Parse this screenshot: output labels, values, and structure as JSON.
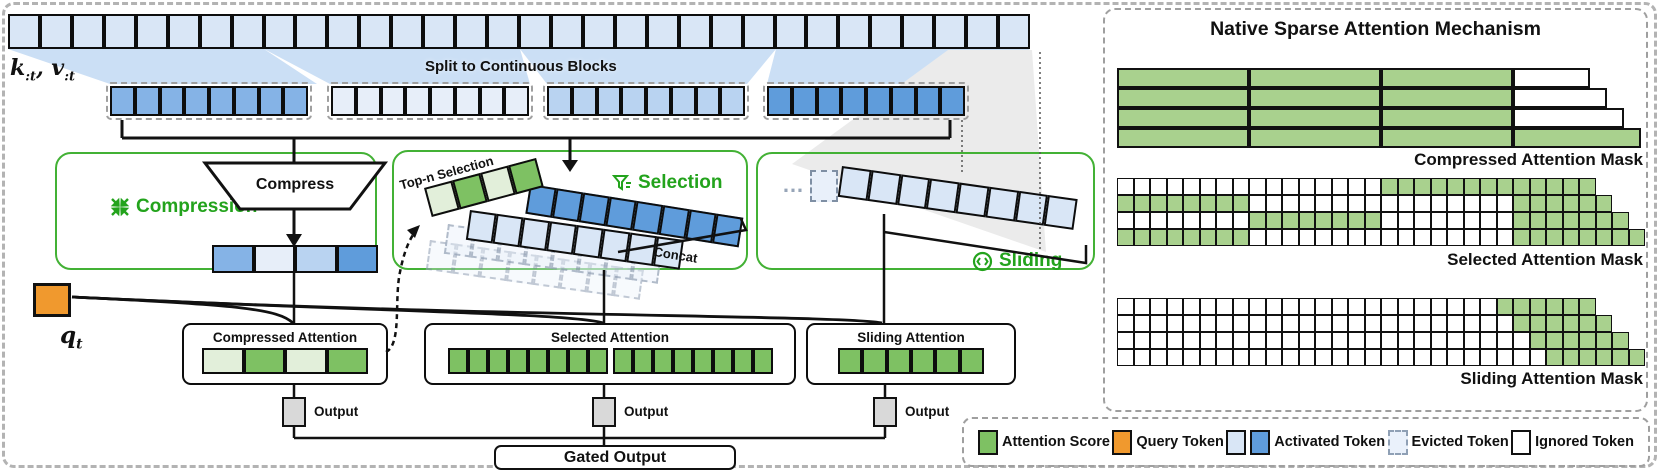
{
  "colors": {
    "green": "#7ec163",
    "pale_green": "#e2efda",
    "mask_green": "#a9d18e",
    "orange": "#f0992e",
    "light_blue": "#d9e6f6",
    "pale_blue": "#e7eef9",
    "soft_blue": "#b9d3f1",
    "medium_blue": "#85b3e6",
    "strong_blue": "#5f9cdb",
    "accent_green": "#23a31c",
    "box_border_green": "#43b135",
    "node_gray": "#d9d9d9",
    "white": "#ffffff"
  },
  "left": {
    "kv": {
      "k": "k",
      "k_sub": ":t",
      "sep": ",",
      "v": "v",
      "v_sub": ":t"
    },
    "q": {
      "base": "q",
      "sub": "t"
    },
    "split_label": "Split to Continuous Blocks",
    "top_row": {
      "count": 32,
      "color": "light_blue"
    },
    "blocks": [
      {
        "count": 8,
        "color": "medium_blue"
      },
      {
        "count": 8,
        "color": "pale_blue"
      },
      {
        "count": 8,
        "color": "soft_blue"
      },
      {
        "count": 8,
        "color": "strong_blue"
      }
    ],
    "compression": {
      "label": "Compression",
      "compress_label": "Compress",
      "icon": "compress-icon",
      "tokens": [
        "medium_blue",
        "pale_blue",
        "soft_blue",
        "strong_blue"
      ]
    },
    "selection": {
      "label": "Selection",
      "icon": "funnel-icon",
      "topn_label": "Top-n Selection",
      "concat_label": "Concat",
      "scores": [
        "pale_green",
        "green",
        "pale_green",
        "green"
      ],
      "selected_row": {
        "count": 8,
        "color": "strong_blue"
      },
      "activated_row": {
        "count": 8,
        "color": "light_blue"
      },
      "ghost_row": {
        "count": 8,
        "color": "pale_blue"
      }
    },
    "sliding": {
      "label": "Sliding",
      "icon": "sliding-icon",
      "dots": "…",
      "window_row": {
        "count": 8,
        "color": "light_blue"
      }
    },
    "attention_boxes": [
      {
        "title": "Compressed Attention",
        "groups": [
          [
            "pale_green",
            "green",
            "pale_green",
            "green"
          ]
        ]
      },
      {
        "title": "Selected Attention",
        "groups": [
          {
            "count": 8,
            "color": "green"
          },
          {
            "count": 8,
            "color": "green"
          }
        ]
      },
      {
        "title": "Sliding Attention",
        "groups": [
          {
            "count": 6,
            "color": "green"
          }
        ]
      }
    ],
    "output_label": "Output",
    "gated_output_label": "Gated Output"
  },
  "right": {
    "title": "Native Sparse Attention Mechanism",
    "compressed_mask": {
      "label": "Compressed Attention Mask",
      "rows": [
        {
          "cells": [
            {
              "w": 132,
              "color": "mask_green"
            },
            {
              "w": 132,
              "color": "mask_green"
            },
            {
              "w": 132,
              "color": "mask_green"
            },
            {
              "w": 77,
              "color": "white"
            }
          ]
        },
        {
          "cells": [
            {
              "w": 132,
              "color": "mask_green"
            },
            {
              "w": 132,
              "color": "mask_green"
            },
            {
              "w": 132,
              "color": "mask_green"
            },
            {
              "w": 94,
              "color": "white"
            }
          ]
        },
        {
          "cells": [
            {
              "w": 132,
              "color": "mask_green"
            },
            {
              "w": 132,
              "color": "mask_green"
            },
            {
              "w": 132,
              "color": "mask_green"
            },
            {
              "w": 111,
              "color": "white"
            }
          ]
        },
        {
          "cells": [
            {
              "w": 132,
              "color": "mask_green"
            },
            {
              "w": 132,
              "color": "mask_green"
            },
            {
              "w": 132,
              "color": "mask_green"
            },
            {
              "w": 128,
              "color": "mask_green"
            }
          ]
        }
      ]
    },
    "selected_mask": {
      "label": "Selected Attention Mask",
      "cell": 16.5,
      "rows": [
        {
          "len": 29,
          "green": [
            [
              17,
              29
            ]
          ]
        },
        {
          "len": 30,
          "green": [
            [
              1,
              8
            ],
            [
              25,
              30
            ]
          ]
        },
        {
          "len": 31,
          "green": [
            [
              9,
              16
            ],
            [
              25,
              31
            ]
          ]
        },
        {
          "len": 32,
          "green": [
            [
              1,
              8
            ],
            [
              25,
              32
            ]
          ]
        }
      ]
    },
    "sliding_mask": {
      "label": "Sliding Attention Mask",
      "cell": 16.5,
      "rows": [
        {
          "len": 29,
          "green": [
            [
              24,
              29
            ]
          ]
        },
        {
          "len": 30,
          "green": [
            [
              25,
              30
            ]
          ]
        },
        {
          "len": 31,
          "green": [
            [
              26,
              31
            ]
          ]
        },
        {
          "len": 32,
          "green": [
            [
              27,
              32
            ]
          ]
        }
      ]
    }
  },
  "legend": {
    "items": [
      {
        "swatch": "attention-score",
        "label": "Attention Score"
      },
      {
        "swatch": "query-token",
        "label": "Query Token"
      },
      {
        "swatch": "activated-token",
        "label": "Activated Token"
      },
      {
        "swatch": "evicted-token",
        "label": "Evicted Token"
      },
      {
        "swatch": "ignored-token",
        "label": "Ignored Token"
      }
    ]
  }
}
